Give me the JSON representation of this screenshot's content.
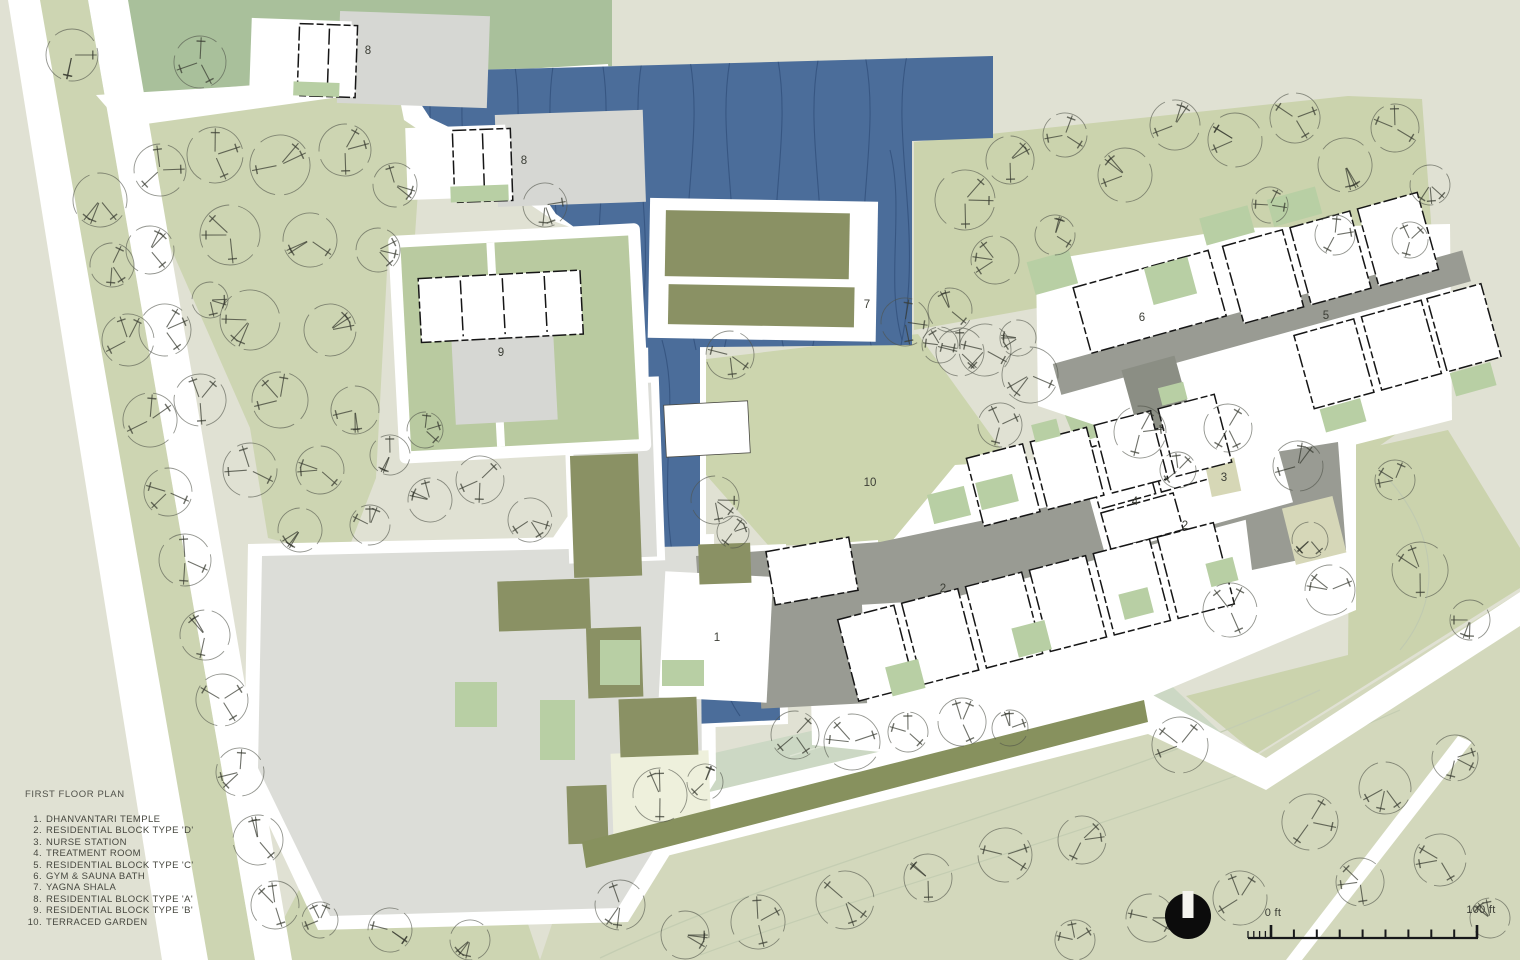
{
  "legend": {
    "title": "FIRST FLOOR PLAN",
    "items": [
      {
        "num": "1.",
        "name": "DHANVANTARI TEMPLE"
      },
      {
        "num": "2.",
        "name": "RESIDENTIAL BLOCK TYPE 'D'"
      },
      {
        "num": "3.",
        "name": "NURSE STATION"
      },
      {
        "num": "4.",
        "name": "TREATMENT ROOM"
      },
      {
        "num": "5.",
        "name": "RESIDENTIAL BLOCK TYPE 'C'"
      },
      {
        "num": "6.",
        "name": "GYM & SAUNA BATH"
      },
      {
        "num": "7.",
        "name": "YAGNA SHALA"
      },
      {
        "num": "8.",
        "name": "RESIDENTIAL BLOCK TYPE 'A'"
      },
      {
        "num": "9.",
        "name": "RESIDENTIAL BLOCK TYPE 'B'"
      },
      {
        "num": "10.",
        "name": "TERRACED GARDEN"
      }
    ]
  },
  "scale_bar": {
    "start_label": "0 ft",
    "end_label": "100 ft"
  },
  "icons": {
    "north_arrow": "filled-circle-with-north-notch"
  },
  "map": {
    "labels": [
      {
        "text": "8",
        "x": 368,
        "y": 54
      },
      {
        "text": "8",
        "x": 524,
        "y": 164
      },
      {
        "text": "9",
        "x": 501,
        "y": 356
      },
      {
        "text": "7",
        "x": 867,
        "y": 308
      },
      {
        "text": "6",
        "x": 1142,
        "y": 321
      },
      {
        "text": "5",
        "x": 1326,
        "y": 319
      },
      {
        "text": "10",
        "x": 870,
        "y": 486
      },
      {
        "text": "4",
        "x": 1135,
        "y": 505
      },
      {
        "text": "3",
        "x": 1224,
        "y": 481
      },
      {
        "text": "2",
        "x": 1185,
        "y": 529
      },
      {
        "text": "2",
        "x": 943,
        "y": 592
      },
      {
        "text": "1",
        "x": 717,
        "y": 641
      }
    ],
    "trees": [
      [
        72,
        55,
        26
      ],
      [
        100,
        200,
        27
      ],
      [
        112,
        265,
        22
      ],
      [
        128,
        340,
        26
      ],
      [
        150,
        420,
        27
      ],
      [
        168,
        492,
        24
      ],
      [
        185,
        560,
        26
      ],
      [
        205,
        635,
        25
      ],
      [
        222,
        700,
        26
      ],
      [
        240,
        772,
        24
      ],
      [
        258,
        840,
        25
      ],
      [
        275,
        905,
        24
      ],
      [
        200,
        62,
        26
      ],
      [
        160,
        170,
        26
      ],
      [
        215,
        155,
        28
      ],
      [
        280,
        165,
        30
      ],
      [
        345,
        150,
        26
      ],
      [
        395,
        185,
        22
      ],
      [
        150,
        250,
        24
      ],
      [
        230,
        235,
        30
      ],
      [
        310,
        240,
        27
      ],
      [
        378,
        250,
        22
      ],
      [
        165,
        330,
        26
      ],
      [
        250,
        320,
        30
      ],
      [
        330,
        330,
        26
      ],
      [
        210,
        300,
        18
      ],
      [
        200,
        400,
        26
      ],
      [
        280,
        400,
        28
      ],
      [
        355,
        410,
        24
      ],
      [
        250,
        470,
        27
      ],
      [
        320,
        470,
        24
      ],
      [
        390,
        455,
        20
      ],
      [
        425,
        430,
        18
      ],
      [
        300,
        530,
        22
      ],
      [
        370,
        525,
        20
      ],
      [
        430,
        500,
        22
      ],
      [
        480,
        480,
        24
      ],
      [
        530,
        520,
        22
      ],
      [
        545,
        205,
        22
      ],
      [
        730,
        355,
        24
      ],
      [
        905,
        322,
        24
      ],
      [
        940,
        345,
        18
      ],
      [
        985,
        350,
        26
      ],
      [
        1030,
        375,
        28
      ],
      [
        1000,
        425,
        22
      ],
      [
        715,
        500,
        24
      ],
      [
        733,
        532,
        16
      ],
      [
        965,
        200,
        30
      ],
      [
        1010,
        160,
        24
      ],
      [
        1065,
        135,
        22
      ],
      [
        1125,
        175,
        27
      ],
      [
        1175,
        125,
        25
      ],
      [
        1235,
        140,
        27
      ],
      [
        1295,
        118,
        25
      ],
      [
        1345,
        165,
        27
      ],
      [
        1395,
        128,
        24
      ],
      [
        1430,
        185,
        20
      ],
      [
        995,
        260,
        24
      ],
      [
        1055,
        235,
        20
      ],
      [
        950,
        310,
        22
      ],
      [
        1270,
        205,
        18
      ],
      [
        1335,
        235,
        20
      ],
      [
        1410,
        240,
        18
      ],
      [
        960,
        352,
        24
      ],
      [
        1018,
        338,
        18
      ],
      [
        1140,
        432,
        26
      ],
      [
        1228,
        428,
        24
      ],
      [
        1298,
        466,
        25
      ],
      [
        1178,
        470,
        18
      ],
      [
        1230,
        610,
        27
      ],
      [
        1330,
        590,
        25
      ],
      [
        1420,
        570,
        28
      ],
      [
        1395,
        480,
        20
      ],
      [
        1470,
        620,
        20
      ],
      [
        1310,
        540,
        18
      ],
      [
        795,
        735,
        24
      ],
      [
        852,
        742,
        28
      ],
      [
        908,
        732,
        20
      ],
      [
        962,
        722,
        24
      ],
      [
        1010,
        728,
        18
      ],
      [
        660,
        795,
        27
      ],
      [
        705,
        782,
        18
      ],
      [
        1180,
        745,
        28
      ],
      [
        620,
        905,
        25
      ],
      [
        685,
        935,
        24
      ],
      [
        758,
        922,
        27
      ],
      [
        845,
        900,
        29
      ],
      [
        928,
        878,
        24
      ],
      [
        1005,
        855,
        27
      ],
      [
        1082,
        840,
        24
      ],
      [
        1150,
        918,
        24
      ],
      [
        1240,
        898,
        27
      ],
      [
        1310,
        822,
        28
      ],
      [
        1385,
        788,
        26
      ],
      [
        1455,
        758,
        23
      ],
      [
        1440,
        860,
        26
      ],
      [
        1360,
        882,
        24
      ],
      [
        1490,
        918,
        20
      ],
      [
        1075,
        940,
        20
      ],
      [
        390,
        930,
        22
      ],
      [
        470,
        940,
        20
      ],
      [
        320,
        920,
        18
      ]
    ]
  },
  "palette": {
    "background": "#e0e1d3",
    "road": "#ffffff",
    "green_light": "#cdd5b2",
    "green_topright": "#cbd3ad",
    "green_court": "#b7cda3",
    "green_band": "#ccd8c4",
    "green_bottom": "#d3d8bc",
    "green_dark_band": "#a9c09b",
    "green_bright": "#b8cfa4",
    "green_compound": "#b9caa0",
    "olive": "#8a9164",
    "olive_band": "#87915e",
    "water": "#4b6d9a",
    "water_line": "#32507c",
    "plaza": "#dcddd8",
    "corridor": "#999b93",
    "roof": "#d6d7d3",
    "building": "#ffffff",
    "wall": "#161616",
    "cream": "#eef0dc",
    "khaki": "#d6d7b6",
    "text": "#3c3e36"
  }
}
